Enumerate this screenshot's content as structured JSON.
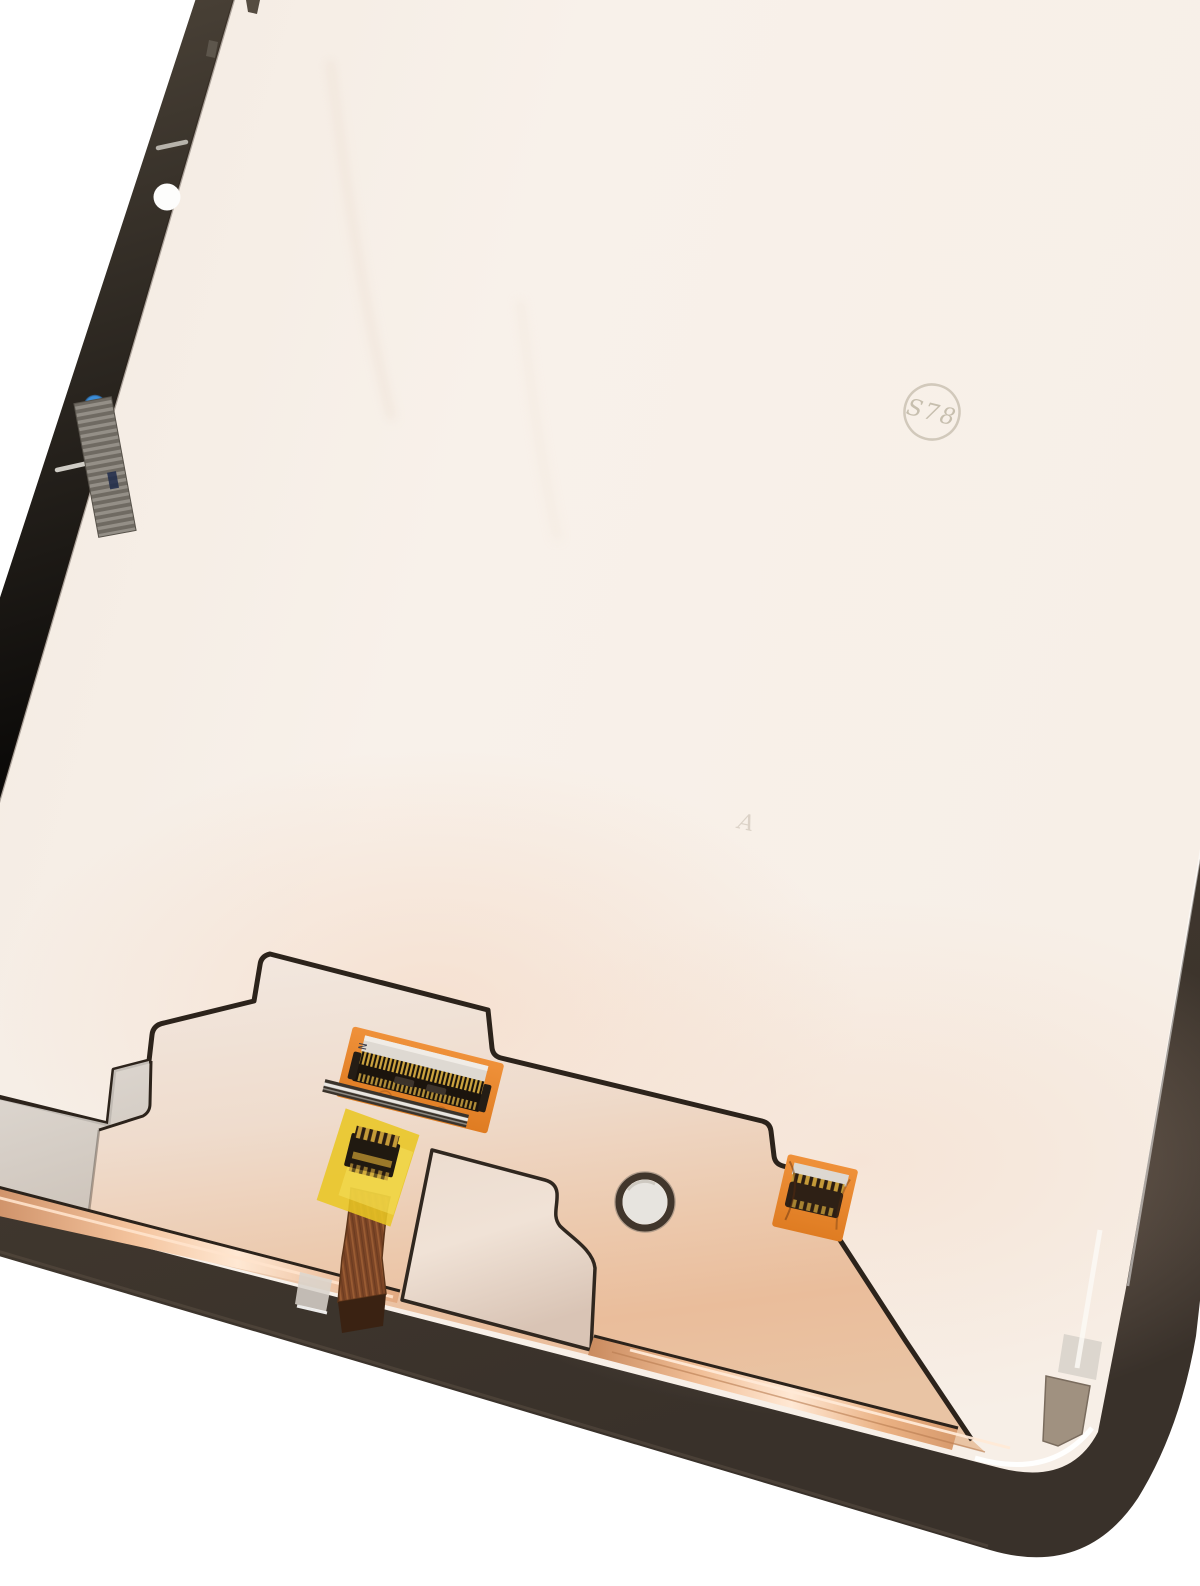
{
  "scene": {
    "type": "product-photo",
    "subject": "Tablet LCD and digitizer screen assembly, rear side, photographed at an angle on a white background",
    "background": "#ffffff"
  },
  "markings": {
    "stamp": "S78",
    "faint_letter": "A",
    "connector_label": "N"
  },
  "colors": {
    "background": "#ffffff",
    "bezel_frame": "#473d32",
    "panel_back_cream": "#f6efe8",
    "copper_plate": "#edcbae",
    "copper_fold_highlight": "#ffe8d3",
    "silver_plate_section": "#d7d2cb",
    "tongue_cutout": "#e7d6c9",
    "fpc_pad_orange": "#e8862c",
    "kapton_tape_yellow": "#e9c623",
    "ribbon_copper_brown": "#7c4526",
    "connector_body_black": "#1b140d",
    "pin_gold": "#cda43f",
    "sticker_blue": "#3c8ed8",
    "sticker_white": "#fdfdfc",
    "grille_grey": "#7b766e",
    "corner_patch_taupe": "#a09180",
    "alignment_hole_fill": "#e7e4df",
    "stamp_ink": "#968c70"
  },
  "parts": {
    "bezel": "display bezel frame",
    "panel_back": "panel rear glass surface",
    "copper_plate": "copper mirror shield plate",
    "silver_plate": "silver shield section",
    "tongue_cutout": "shield cut-out tongue",
    "main_connector": "LCD flex ZIF connector on orange pad",
    "aux_connector": "taped flex connector with ribbon cable",
    "right_connector": "small touch flex connector",
    "alignment_hole": "round alignment hole",
    "blue_sticker": "blue dot QC sticker",
    "white_sticker": "white dot QC sticker",
    "grille_patch": "striped mesh patch",
    "corner_patch": "taupe corner patch"
  }
}
